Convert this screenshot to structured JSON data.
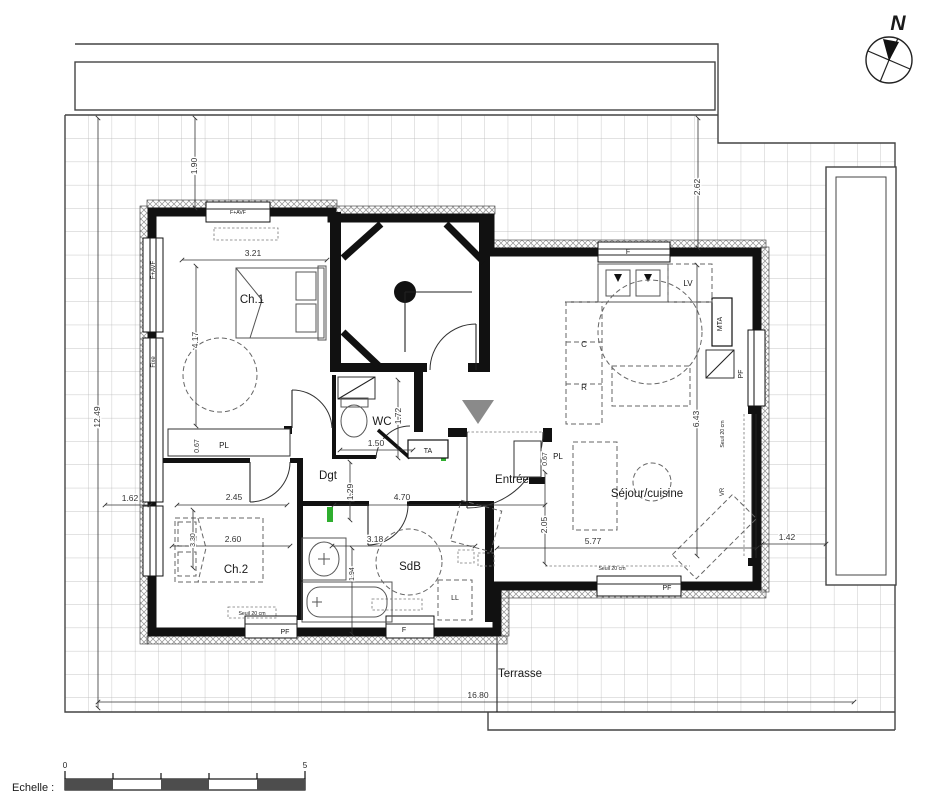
{
  "north": {
    "label": "N"
  },
  "scale_bar": {
    "label": "Echelle :",
    "start": "0",
    "end": "5"
  },
  "rooms": {
    "ch1": "Ch.1",
    "ch2": "Ch.2",
    "wc": "WC",
    "sdb": "SdB",
    "dgt": "Dgt",
    "entree": "Entrée",
    "sejour": "Séjour/cuisine",
    "terrasse": "Terrasse"
  },
  "fixtures": {
    "pl1": "PL",
    "pl2": "PL",
    "ta": "TA",
    "lv": "LV",
    "c": "C",
    "r": "R",
    "mta": "MTA",
    "ll": "LL",
    "vr": "VR",
    "fixe": "Fixe",
    "favf_left": "F+AVF",
    "favf_top": "F+AVF",
    "f_top": "F",
    "f_bottom": "F",
    "pf_right": "PF",
    "pf_ch2": "PF",
    "pf_sejour": "PF",
    "seuil_right": "Seuil 20 cm",
    "seuil_sejour": "Seuil 20 cm",
    "seuil_ch2": "Seuil 20 cm"
  },
  "dims": {
    "d190": "1.90",
    "d262": "2.62",
    "d321": "3.21",
    "d417": "4.17",
    "d1249": "12.49",
    "d162": "1.62",
    "d245": "2.45",
    "d470": "4.70",
    "d129": "1.29",
    "d150": "1.50",
    "d172": "1.72",
    "d067a": "0.67",
    "d067b": "0.67",
    "d260": "2.60",
    "d318": "3.18",
    "d194": "1.94",
    "d205": "2.05",
    "d577": "5.77",
    "d643": "6.43",
    "d142": "1.42",
    "d1680": "16.80",
    "d330": "3.30"
  },
  "colors": {
    "wall": "#111111",
    "grid": "#b3b3b3",
    "hatch": "#909090",
    "dim_text": "#333333",
    "accent_green": "#2fae2f",
    "triangle_gray": "#8a8a8a",
    "scale_dark": "#4d4d4d"
  }
}
